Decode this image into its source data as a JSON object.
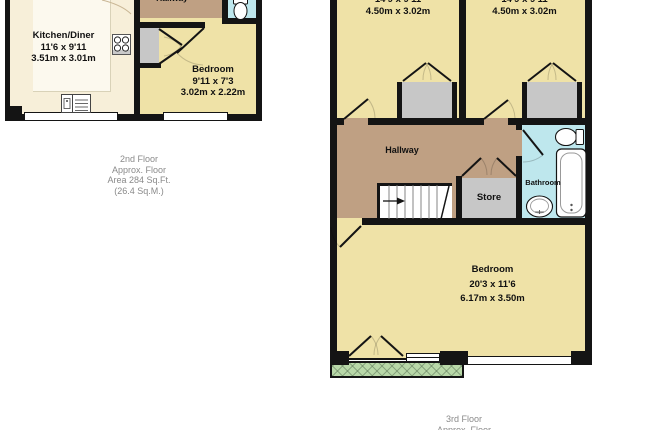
{
  "floors": {
    "second": {
      "hallway_label": "Hallway",
      "kitchen": {
        "name": "Kitchen/Diner",
        "imperial": "11'6 x 9'11",
        "metric": "3.51m x 3.01m"
      },
      "bedroom": {
        "name": "Bedroom",
        "imperial": "9'11 x 7'3",
        "metric": "3.02m x 2.22m"
      },
      "caption": {
        "l1": "2nd Floor",
        "l2": "Approx. Floor",
        "l3": "Area 284 Sq.Ft.",
        "l4": "(26.4 Sq.M.)"
      }
    },
    "third": {
      "room_left": {
        "imperial": "14'9 x 9'11",
        "metric": "4.50m x 3.02m"
      },
      "room_right": {
        "imperial": "14'9 x 9'11",
        "metric": "4.50m x 3.02m"
      },
      "hallway_label": "Hallway",
      "store_label": "Store",
      "bathroom_label": "Bathroom",
      "bedroom": {
        "name": "Bedroom",
        "imperial": "20'3 x 11'6",
        "metric": "6.17m x 3.50m"
      },
      "caption": {
        "l1": "3rd Floor",
        "l2": "Approx. Floor"
      }
    }
  },
  "colors": {
    "wall": "#141414",
    "kitchen_floor": "#f7efd9",
    "bedroom_floor": "#efe2a7",
    "hallway_floor": "#bfa083",
    "bathroom_floor": "#bee7ed",
    "storage_gray": "#c7c7c7",
    "balcony_green": "#b8d8a8",
    "caption_text": "#8a8a8a"
  }
}
